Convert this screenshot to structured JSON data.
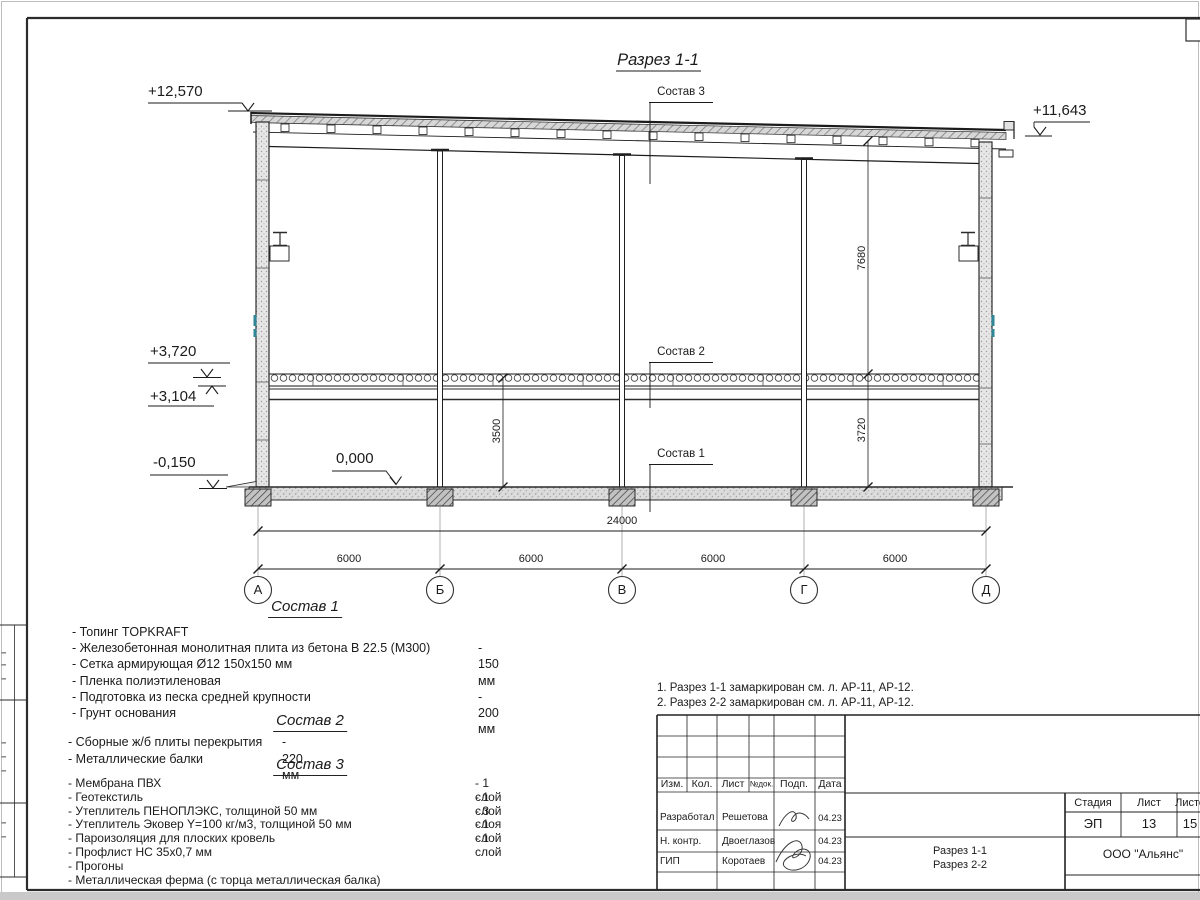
{
  "page": {
    "title": "Разрез 1-1"
  },
  "drawing": {
    "labels": {
      "sostav1": "Состав 1",
      "sostav2": "Состав 2",
      "sostav3": "Состав 3",
      "zero_level": "0,000"
    },
    "elevations": {
      "roof_left": "+12,570",
      "roof_right": "+11,643",
      "slab_top": "+3,720",
      "slab_bottom": "+3,104",
      "ground": "-0,150"
    },
    "dimensions": {
      "total_width": "24000",
      "bay1": "6000",
      "bay2": "6000",
      "bay3": "6000",
      "bay4": "6000",
      "h_first_floor": "3500",
      "h_upper": "7680",
      "h_lower": "3720"
    },
    "axes": {
      "a1": "А",
      "a2": "Б",
      "a3": "В",
      "a4": "Г",
      "a5": "Д"
    }
  },
  "compositions": {
    "c1": {
      "title": "Состав 1",
      "items": [
        {
          "text": "- Топинг TOPKRAFT",
          "value": ""
        },
        {
          "text": "- Железобетонная  монолитная плита из бетона  В 22.5 (М300)",
          "value": "- 150 мм"
        },
        {
          "text": "- Сетка армирующая Ø12 150х150 мм",
          "value": ""
        },
        {
          "text": "- Пленка полиэтиленовая",
          "value": ""
        },
        {
          "text": "- Подготовка из песка средней  крупности",
          "value": "- 200 мм"
        },
        {
          "text": "- Грунт основания",
          "value": ""
        }
      ]
    },
    "c2": {
      "title": "Состав 2",
      "items": [
        {
          "text": "- Сборные ж/б плиты перекрытия",
          "value": "- 220 мм"
        },
        {
          "text": "- Металлические балки",
          "value": ""
        }
      ]
    },
    "c3": {
      "title": "Состав 3",
      "items": [
        {
          "text": "- Мембрана ПВХ",
          "value": "- 1 слой"
        },
        {
          "text": "- Геотекстиль",
          "value": "- 1 слой"
        },
        {
          "text": "- Утеплитель ПЕНОПЛЭКС, толщиной 50 мм",
          "value": "- 3 слоя"
        },
        {
          "text": "- Утеплитель Эковер Y=100 кг/м3, толщиной 50 мм",
          "value": "- 1 слой"
        },
        {
          "text": "- Пароизоляция для плоских кровель",
          "value": "- 1 слой"
        },
        {
          "text": "- Профлист НС 35х0,7 мм",
          "value": ""
        },
        {
          "text": "- Прогоны",
          "value": ""
        },
        {
          "text": "- Металлическая ферма (с торца металлическая балка)",
          "value": ""
        }
      ]
    }
  },
  "notes": {
    "n1": "1. Разрез 1-1 замаркирован см. л. АР-11, АР-12.",
    "n2": "2. Разрез 2-2 замаркирован см. л. АР-11, АР-12."
  },
  "titleblock": {
    "header": {
      "izm": "Изм.",
      "kol": "Кол.",
      "list": "Лист",
      "ndoc": "№док.",
      "podp": "Подп.",
      "data": "Дата"
    },
    "rows": {
      "r1": {
        "role": "Разработал",
        "name": "Решетова",
        "date": "04.23"
      },
      "r2": {
        "role": "Н. контр.",
        "name": "Двоеглазов",
        "date": "04.23"
      },
      "r3": {
        "role": "ГИП",
        "name": "Коротаев",
        "date": "04.23"
      }
    },
    "stage": {
      "h1": "Стадия",
      "h2": "Лист",
      "h3": "Листов",
      "v1": "ЭП",
      "v2": "13",
      "v3": "15"
    },
    "doc_name_line1": "Разрез 1-1",
    "doc_name_line2": "Разрез 2-2",
    "company": "ООО \"Альянс\""
  }
}
